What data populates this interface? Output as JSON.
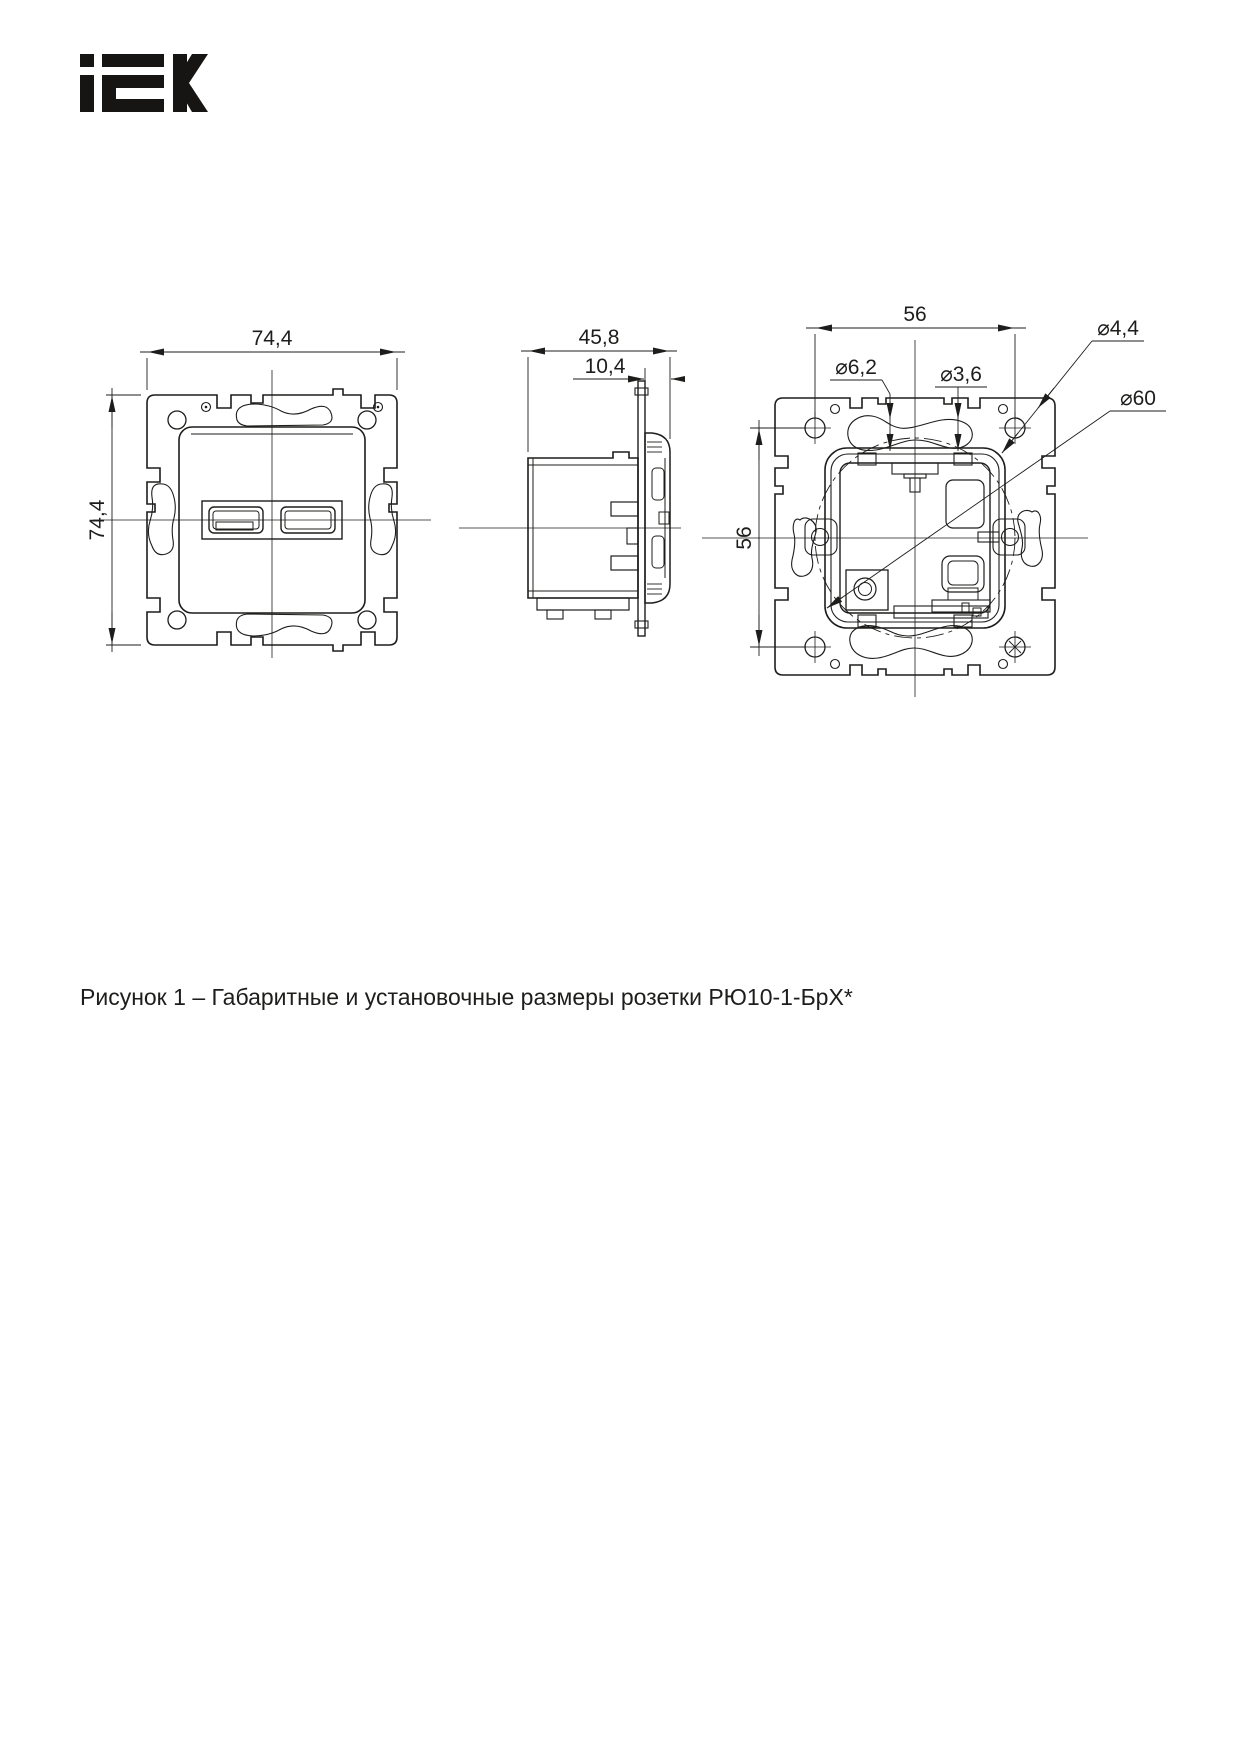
{
  "page": {
    "background": "#ffffff",
    "ink_color": "#1d1d1b"
  },
  "logo": {
    "brand": "IEK",
    "aria": "IEK logo"
  },
  "figure": {
    "caption": "Рисунок 1 – Габаритные и установочные размеры розетки РЮ10-1-БрХ*"
  },
  "views": {
    "front": {
      "dim_width": "74,4",
      "dim_height": "74,4"
    },
    "side": {
      "dim_depth": "45,8",
      "dim_front": "10,4"
    },
    "rear": {
      "dim_hspacing": "56",
      "dim_vspacing": "56",
      "dim_slot": "⌀6,2",
      "dim_hole": "⌀3,6",
      "dim_corner_hole": "⌀4,4",
      "dim_circle": "⌀60"
    }
  }
}
